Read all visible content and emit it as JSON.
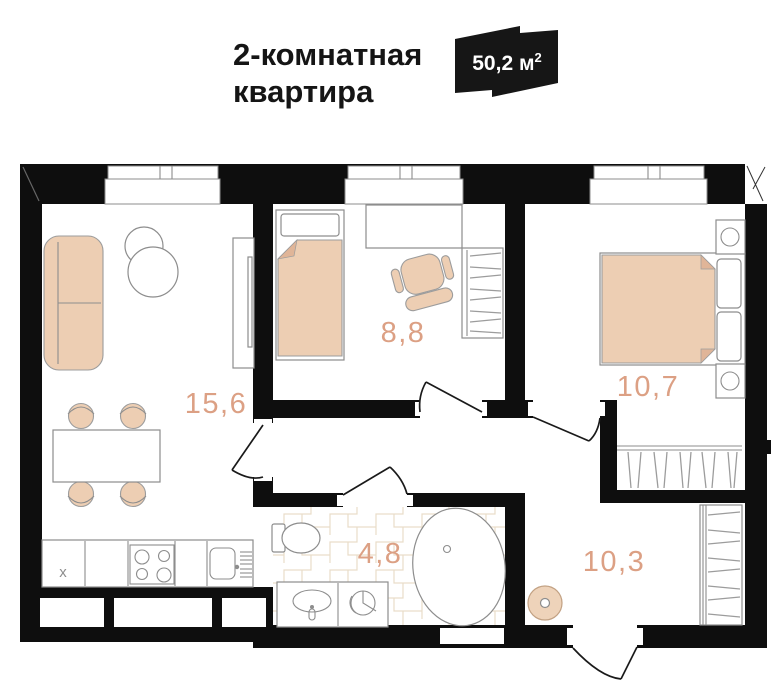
{
  "header": {
    "title_line1": "2-комнатная",
    "title_line2": "квартира",
    "badge": {
      "value_with_unit": "50,2 м",
      "superscript": "2",
      "bg_color": "#161616",
      "text_color": "#ffffff"
    }
  },
  "plan": {
    "rooms": {
      "living_kitchen": {
        "label": "15,6"
      },
      "bedroom_small": {
        "label": "8,8"
      },
      "bedroom_main": {
        "label": "10,7"
      },
      "bathroom": {
        "label": "4,8"
      },
      "hallway": {
        "label": "10,3"
      }
    },
    "kitchen_fridge_mark": "x",
    "colors": {
      "wall": "#0e0e0e",
      "furniture_fill": "#edceb3",
      "furniture_stroke": "#8d8d8d",
      "room_label": "#dca084",
      "tile_stroke": "#e9ddc9"
    }
  }
}
